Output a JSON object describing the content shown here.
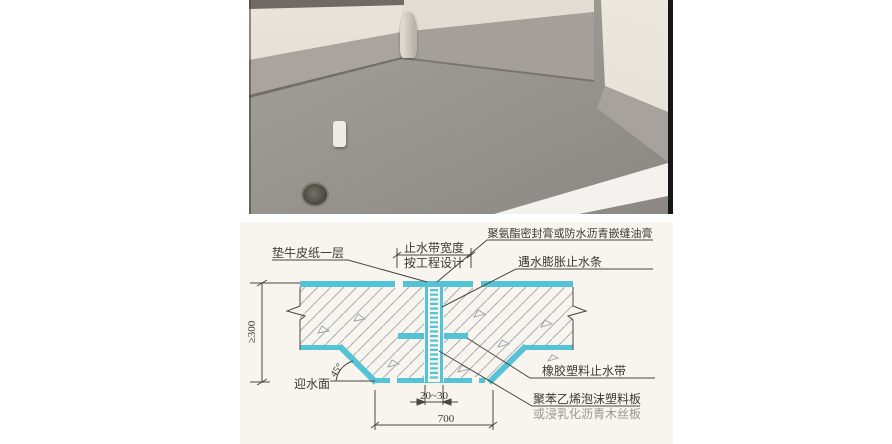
{
  "figure": {
    "photo": {
      "colors": {
        "wall": "#e6e2d8",
        "skirting_band": "#a8a49d",
        "floor_coating": "#96938d",
        "sunlight": "#f3f2ee",
        "frame": "#161616"
      }
    },
    "diagram": {
      "accent_cyan": "#54c3d6",
      "paper": "#f8f4ee",
      "line_color": "#4a4742",
      "labels": {
        "kraft_paper": "垫牛皮纸一层",
        "waterstop_width_line1": "止水带宽度",
        "waterstop_width_line2": "按工程设计",
        "sealant": "聚氨酯密封膏或防水沥青嵌缝油膏",
        "swelling_strip": "遇水膨胀止水条",
        "rubber_waterstop": "橡胶塑料止水带",
        "foam_board_line1": "聚苯乙烯泡沫塑料板",
        "foam_board_line2": "或浸乳化沥青木丝板",
        "water_facing_side": "迎水面"
      },
      "dimensions": {
        "slab_thickness": "≥300",
        "chamfer_angle": "45°",
        "joint_width": "20~30",
        "bottom_width": "700"
      }
    }
  }
}
